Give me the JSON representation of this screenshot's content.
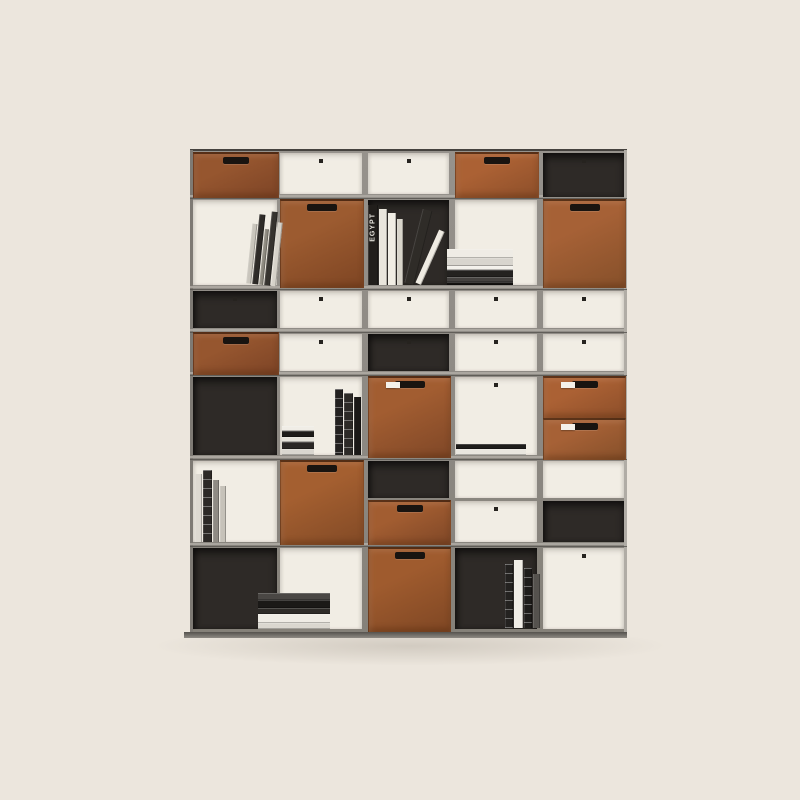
{
  "image_type": "product-photograph",
  "subject": "modular gray metal bookcase with cognac leather storage drawers, open compartments and books, on a plain beige studio background",
  "background_color": "#ece6dd",
  "palette": {
    "frame": "#8f8b85",
    "frame_light": "#b0aca5",
    "frame_dark": "#55524d",
    "frame_side_left": "#7e7a74",
    "open_back": "#f1ede4",
    "dark_back": "#2e2a27",
    "handle": "#191410",
    "tag": "#f4f1ea",
    "plinth": "#8e8a83",
    "top_edge": "#45423e",
    "shadow": "rgba(90,80,65,0.18)"
  },
  "leathers": {
    "A": [
      "#96562f",
      "#7d4426"
    ],
    "B": [
      "#ab6134",
      "#8d4f2a"
    ],
    "C": [
      "#9c5b30",
      "#7e4523"
    ],
    "D": [
      "#a66136",
      "#86502a"
    ],
    "E": [
      "#a25d31",
      "#7f4727"
    ],
    "F": [
      "#a45f30",
      "#824a26"
    ],
    "G": [
      "#9f5b2e",
      "#7f4724"
    ]
  },
  "unit": {
    "x": 190,
    "y": 150,
    "w": 437,
    "h": 482
  },
  "grid": {
    "col_bounds": [
      190,
      277,
      365,
      452,
      540,
      627
    ],
    "row_bounds": [
      150,
      197,
      288,
      331,
      374,
      458,
      545,
      632
    ]
  },
  "cells": [
    {
      "id": "r0c0",
      "rect": [
        193,
        152,
        84,
        44
      ],
      "type": "drawer",
      "leather": "A"
    },
    {
      "id": "r0c1",
      "rect": [
        280,
        153,
        82,
        41
      ],
      "type": "open",
      "dot": true
    },
    {
      "id": "r0c2",
      "rect": [
        368,
        153,
        81,
        41
      ],
      "type": "open",
      "dot": true
    },
    {
      "id": "r0c3",
      "rect": [
        455,
        152,
        82,
        44
      ],
      "type": "drawer",
      "leather": "B"
    },
    {
      "id": "r0c4",
      "rect": [
        543,
        153,
        81,
        44
      ],
      "type": "dark",
      "dot": true
    },
    {
      "id": "r1c0",
      "rect": [
        193,
        200,
        84,
        85
      ],
      "type": "open"
    },
    {
      "id": "r1c1",
      "rect": [
        280,
        199,
        82,
        87
      ],
      "type": "box",
      "leather": "C"
    },
    {
      "id": "r1c2",
      "rect": [
        368,
        200,
        81,
        85
      ],
      "type": "dark"
    },
    {
      "id": "r1c3",
      "rect": [
        455,
        200,
        82,
        85
      ],
      "type": "open"
    },
    {
      "id": "r1c4",
      "rect": [
        543,
        199,
        81,
        87
      ],
      "type": "box",
      "leather": "D"
    },
    {
      "id": "r2c0",
      "rect": [
        193,
        291,
        84,
        37
      ],
      "type": "dark",
      "dot": true
    },
    {
      "id": "r2c1",
      "rect": [
        280,
        291,
        82,
        37
      ],
      "type": "open",
      "dot": true
    },
    {
      "id": "r2c2",
      "rect": [
        368,
        291,
        81,
        37
      ],
      "type": "open",
      "dot": true
    },
    {
      "id": "r2c3",
      "rect": [
        455,
        291,
        82,
        37
      ],
      "type": "open",
      "dot": true
    },
    {
      "id": "r2c4",
      "rect": [
        543,
        291,
        81,
        37
      ],
      "type": "open",
      "dot": true
    },
    {
      "id": "r3c0",
      "rect": [
        193,
        332,
        84,
        41
      ],
      "type": "drawer",
      "leather": "A"
    },
    {
      "id": "r3c1",
      "rect": [
        280,
        334,
        82,
        37
      ],
      "type": "open",
      "dot": true
    },
    {
      "id": "r3c2",
      "rect": [
        368,
        334,
        81,
        37
      ],
      "type": "dark",
      "dot": true
    },
    {
      "id": "r3c3",
      "rect": [
        455,
        334,
        82,
        37
      ],
      "type": "open",
      "dot": true
    },
    {
      "id": "r3c4",
      "rect": [
        543,
        334,
        81,
        37
      ],
      "type": "open",
      "dot": true
    },
    {
      "id": "r4c0",
      "rect": [
        193,
        377,
        84,
        78
      ],
      "type": "dark"
    },
    {
      "id": "r4c1",
      "rect": [
        280,
        377,
        82,
        78
      ],
      "type": "open"
    },
    {
      "id": "r4c2",
      "rect": [
        368,
        376,
        81,
        80
      ],
      "type": "box",
      "leather": "E",
      "tag": true
    },
    {
      "id": "r4c3",
      "rect": [
        455,
        377,
        82,
        78
      ],
      "type": "open",
      "dot": true
    },
    {
      "id": "r4c4a",
      "rect": [
        543,
        376,
        81,
        40
      ],
      "type": "drawer",
      "leather": "B",
      "tag": true
    },
    {
      "id": "r4c4b",
      "rect": [
        543,
        418,
        81,
        40
      ],
      "type": "drawer",
      "leather": "D",
      "tag": true
    },
    {
      "id": "r5c0",
      "rect": [
        193,
        461,
        84,
        81
      ],
      "type": "open"
    },
    {
      "id": "r5c1",
      "rect": [
        280,
        460,
        82,
        83
      ],
      "type": "box",
      "leather": "F"
    },
    {
      "id": "r5c2a",
      "rect": [
        368,
        461,
        81,
        37
      ],
      "type": "dark"
    },
    {
      "id": "r5c2b",
      "rect": [
        368,
        500,
        81,
        43
      ],
      "type": "drawer",
      "leather": "E"
    },
    {
      "id": "r5c3a",
      "rect": [
        455,
        461,
        82,
        37
      ],
      "type": "open"
    },
    {
      "id": "r5c3b",
      "rect": [
        455,
        501,
        82,
        41
      ],
      "type": "open",
      "dot": true
    },
    {
      "id": "r5c4a",
      "rect": [
        543,
        461,
        81,
        37
      ],
      "type": "open"
    },
    {
      "id": "r5c4b",
      "rect": [
        543,
        501,
        81,
        41
      ],
      "type": "dark"
    },
    {
      "id": "r6c0",
      "rect": [
        193,
        548,
        84,
        81
      ],
      "type": "dark"
    },
    {
      "id": "r6c1",
      "rect": [
        280,
        548,
        82,
        81
      ],
      "type": "open"
    },
    {
      "id": "r6c2",
      "rect": [
        368,
        547,
        81,
        83
      ],
      "type": "box",
      "leather": "G"
    },
    {
      "id": "r6c3",
      "rect": [
        455,
        548,
        82,
        81
      ],
      "type": "dark"
    },
    {
      "id": "r6c4",
      "rect": [
        543,
        548,
        81,
        81
      ],
      "type": "open",
      "dot": true
    }
  ],
  "books": [
    {
      "id": "lean-books-top-left",
      "kind": "vertical",
      "x": 250,
      "bottom": 285,
      "lean": 6,
      "spines": [
        {
          "w": 5,
          "h": 60,
          "c": "#c9c5bc"
        },
        {
          "w": 6,
          "h": 70,
          "c": "#2e2b28"
        },
        {
          "w": 4,
          "h": 56,
          "c": "#8d897f"
        },
        {
          "w": 6,
          "h": 74,
          "c": "#36332f"
        },
        {
          "w": 5,
          "h": 64,
          "c": "#d6d2c9"
        }
      ]
    },
    {
      "id": "egypt-books",
      "kind": "vertical",
      "x": 368,
      "bottom": 285,
      "spines": [
        {
          "w": 10,
          "h": 80,
          "c": "#211e1b",
          "label": "EGYPT",
          "lc": "#e8e5de"
        },
        {
          "w": 8,
          "h": 76,
          "c": "#e9e5dc"
        },
        {
          "w": 8,
          "h": 72,
          "c": "#f1ede4"
        },
        {
          "w": 6,
          "h": 66,
          "c": "#d9d5cb"
        },
        {
          "w": 10,
          "h": 76,
          "c": "#2f2c28",
          "lean": 14
        },
        {
          "w": 6,
          "h": 58,
          "c": "#efebe2",
          "lean": 24
        }
      ]
    },
    {
      "id": "magazine-stack-top-right",
      "kind": "stack",
      "x": 447,
      "w": 66,
      "bottom": 285,
      "layers": [
        {
          "h": 9,
          "c": "#efece5"
        },
        {
          "h": 8,
          "c": "#d8d5ce"
        },
        {
          "h": 4,
          "c": "#f3f1eb"
        },
        {
          "h": 7,
          "c": "#242220"
        },
        {
          "h": 5,
          "c": "#454240"
        },
        {
          "h": 3,
          "c": "#141210"
        }
      ]
    },
    {
      "id": "mid-stack",
      "kind": "stack",
      "x": 282,
      "w": 32,
      "bottom": 455,
      "layers": [
        {
          "h": 5,
          "c": "#f0ede6"
        },
        {
          "h": 6,
          "c": "#1d1b19"
        },
        {
          "h": 5,
          "c": "#e6e3db"
        },
        {
          "h": 7,
          "c": "#2a2725"
        },
        {
          "h": 6,
          "c": "#d9d6cf"
        }
      ]
    },
    {
      "id": "mid-dark-books",
      "kind": "vertical",
      "x": 335,
      "bottom": 455,
      "spines": [
        {
          "w": 8,
          "h": 66,
          "c": "#232120",
          "stripes": true
        },
        {
          "w": 9,
          "h": 62,
          "c": "#2d2a27",
          "stripes": true
        },
        {
          "w": 7,
          "h": 58,
          "c": "#1b1917"
        }
      ]
    },
    {
      "id": "thin-pair",
      "kind": "stack",
      "x": 456,
      "w": 70,
      "bottom": 455,
      "layers": [
        {
          "h": 5,
          "c": "#1f1d1b"
        },
        {
          "h": 6,
          "c": "#e9e6df"
        }
      ]
    },
    {
      "id": "left-standing-books",
      "kind": "vertical",
      "x": 195,
      "bottom": 542,
      "spines": [
        {
          "w": 7,
          "h": 68,
          "c": "#ddd9d1"
        },
        {
          "w": 9,
          "h": 72,
          "c": "#2c2926",
          "stripes": true
        },
        {
          "w": 6,
          "h": 62,
          "c": "#8f8b84"
        },
        {
          "w": 6,
          "h": 56,
          "c": "#c6c2b9"
        }
      ]
    },
    {
      "id": "bottom-stack",
      "kind": "stack",
      "x": 258,
      "w": 72,
      "bottom": 629,
      "layers": [
        {
          "h": 7,
          "c": "#4a4744"
        },
        {
          "h": 8,
          "c": "#1b1917"
        },
        {
          "h": 6,
          "c": "#2e2b28"
        },
        {
          "h": 9,
          "c": "#efece5"
        },
        {
          "h": 6,
          "c": "#dad7cf"
        }
      ]
    },
    {
      "id": "bottom-right-books",
      "kind": "vertical",
      "x": 505,
      "bottom": 628,
      "spines": [
        {
          "w": 8,
          "h": 64,
          "c": "#242220",
          "stripes": true
        },
        {
          "w": 9,
          "h": 68,
          "c": "#f0ede6"
        },
        {
          "w": 8,
          "h": 60,
          "c": "#1e1c1a",
          "stripes": true
        },
        {
          "w": 7,
          "h": 54,
          "c": "#55524e"
        }
      ]
    }
  ],
  "spine_label": "EGYPT"
}
